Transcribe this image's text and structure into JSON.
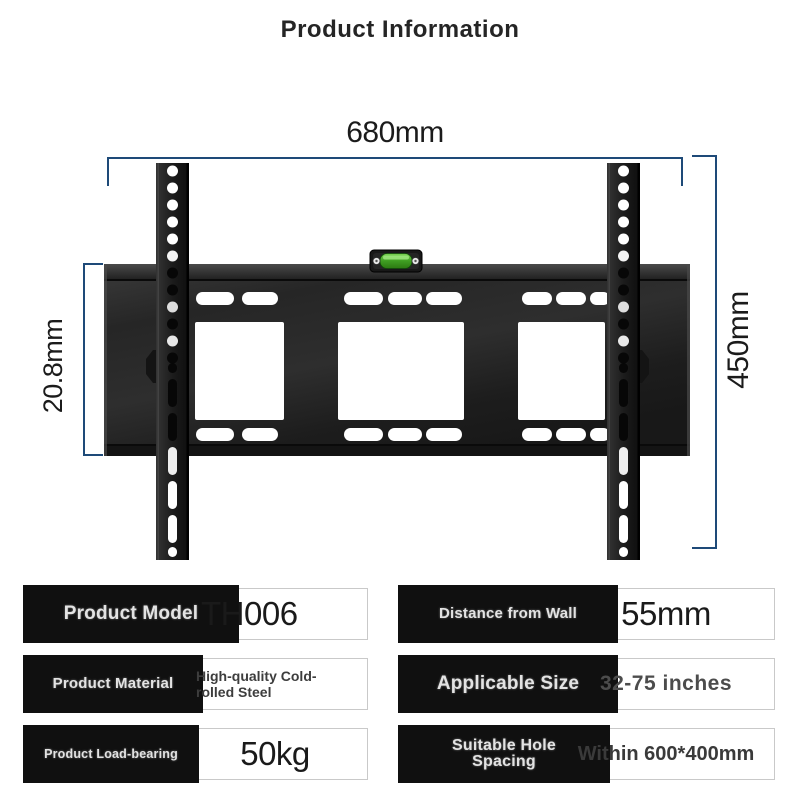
{
  "title": "Product Information",
  "diagram": {
    "width_label": "680mm",
    "height_label": "450mm",
    "depth_label": "20.8mm",
    "dimension_color": "#1e4a78",
    "bracket_color": "#222222",
    "level_color": "#4aa62c"
  },
  "spec_table": {
    "left": [
      {
        "label": "Product Model",
        "value": "TH006"
      },
      {
        "label": "Product Material",
        "value": "High-quality Cold-rolled Steel"
      },
      {
        "label": "Product Load-bearing",
        "value": "50kg"
      }
    ],
    "right": [
      {
        "label": "Distance from Wall",
        "value": "55mm"
      },
      {
        "label": "Applicable Size",
        "value": "32-75 inches"
      },
      {
        "label": "Suitable Hole Spacing",
        "value": "Within 600*400mm"
      }
    ]
  }
}
